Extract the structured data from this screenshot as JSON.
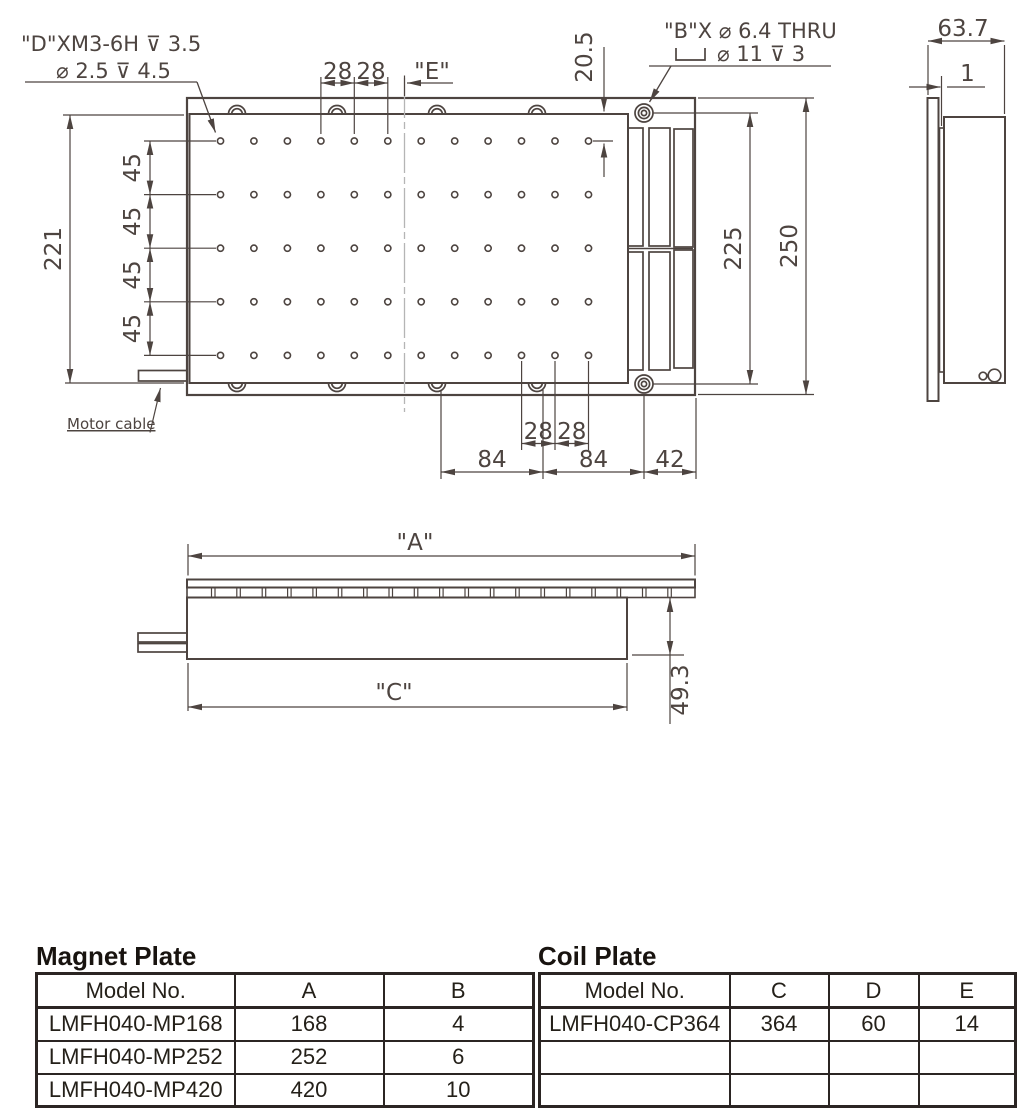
{
  "drawing": {
    "notes": {
      "d_hole_line1": "\"D\"XM3-6H ⊽ 3.5",
      "d_hole_line2": "⌀ 2.5 ⊽ 4.5",
      "b_hole_line1": "\"B\"X ⌀ 6.4 THRU",
      "b_hole_line2": "⌀ 11 ⊽ 3",
      "motor_cable": "Motor cable"
    },
    "dims": {
      "hole_pitch_top": [
        "28",
        "28"
      ],
      "e_ref": "\"E\"",
      "top_offset": "20.5",
      "left_height": "221",
      "row_pitch": [
        "45",
        "45",
        "45",
        "45"
      ],
      "inner_height": "225",
      "overall_height": "250",
      "side_width": "63.7",
      "gap": "1",
      "hole_pitch_bottom": [
        "28",
        "28"
      ],
      "bottom_spacing": [
        "84",
        "84",
        "42"
      ],
      "a_ref": "\"A\"",
      "c_ref": "\"C\"",
      "front_height": "49.3"
    }
  },
  "tables": {
    "magnet_plate": {
      "title": "Magnet Plate",
      "headers": [
        "Model No.",
        "A",
        "B"
      ],
      "rows": [
        [
          "LMFH040-MP168",
          "168",
          "4"
        ],
        [
          "LMFH040-MP252",
          "252",
          "6"
        ],
        [
          "LMFH040-MP420",
          "420",
          "10"
        ]
      ]
    },
    "coil_plate": {
      "title": "Coil Plate",
      "headers": [
        "Model No.",
        "C",
        "D",
        "E"
      ],
      "rows": [
        [
          "LMFH040-CP364",
          "364",
          "60",
          "14"
        ],
        [
          "",
          "",
          "",
          ""
        ],
        [
          "",
          "",
          "",
          ""
        ]
      ]
    }
  },
  "colors": {
    "line": "#4d4440",
    "centerline": "#b5b5b5",
    "table_border": "#2b2523",
    "table_text": "#242019"
  }
}
